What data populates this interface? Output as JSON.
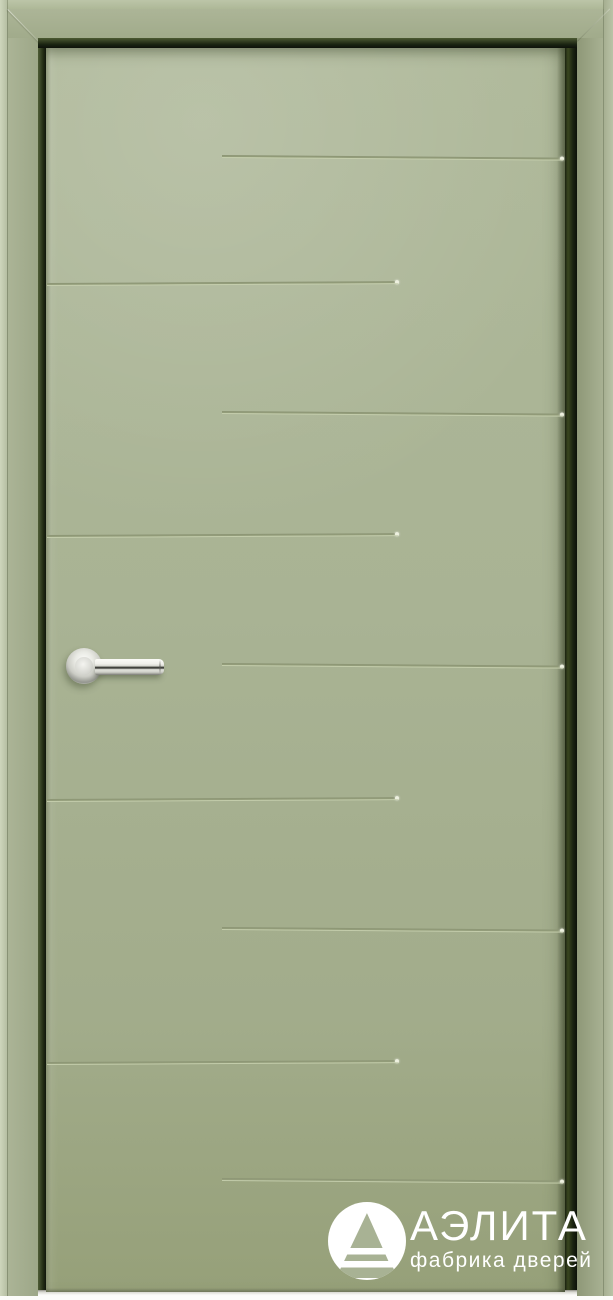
{
  "brand": {
    "name": "АЭЛИТА",
    "tagline": "фабрика дверей",
    "logo_mark": "triangle-a-in-circle-icon",
    "text_color": "#ffffff"
  },
  "door": {
    "description": "painted interior door leaf in frame, horizontal milled grooves, chrome lever handle",
    "colors": {
      "leaf": "#a8b294",
      "leaf_highlight": "#b2bc9d",
      "leaf_shadow": "#96a079",
      "frame": "#a4ae91",
      "frame_edge_highlight": "#c8d1b6",
      "rebate_gap": "#10160b",
      "groove_dark": "#8b9474",
      "groove_light": "#c6cfae",
      "handle_chrome": "#e9eae4",
      "floor": "#fbfbf8"
    },
    "grooves": [
      {
        "y": 155,
        "side": "right"
      },
      {
        "y": 283,
        "side": "left"
      },
      {
        "y": 411,
        "side": "right"
      },
      {
        "y": 535,
        "side": "left"
      },
      {
        "y": 663,
        "side": "right"
      },
      {
        "y": 799,
        "side": "left"
      },
      {
        "y": 927,
        "side": "right"
      },
      {
        "y": 1062,
        "side": "left"
      },
      {
        "y": 1178,
        "side": "right"
      }
    ],
    "handle": {
      "type": "lever-on-round-rosette",
      "finish": "polished-chrome"
    }
  }
}
